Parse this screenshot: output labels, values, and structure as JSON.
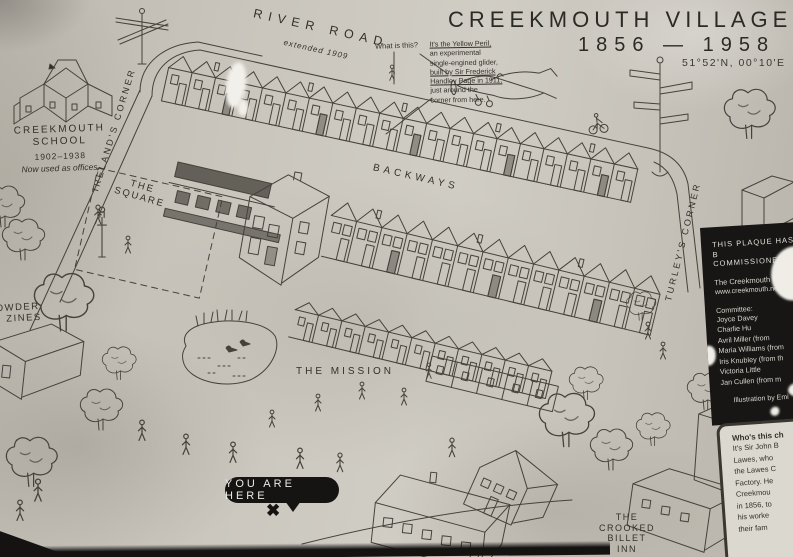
{
  "title": {
    "name": "CREEKMOUTH VILLAGE",
    "years": "1856 — 1958",
    "coordinates": "51°52'N, 00°10'E"
  },
  "map_labels": {
    "river_road": "RIVER ROAD",
    "river_road_note": "extended 1909",
    "irelands_corner": "IRELAND'S CORNER",
    "turleys_corner": "TURLEY'S CORNER",
    "the_square_line1": "THE",
    "the_square_line2": "SQUARE",
    "backways": "BACKWAYS",
    "the_mission": "THE MISSION",
    "powder_magazines_line1": "OWDER",
    "powder_magazines_line2": "ZINES",
    "crooked_billet_line1": "THE",
    "crooked_billet_line2": "CROOKED",
    "crooked_billet_line3": "BILLET",
    "crooked_billet_line4": "INN"
  },
  "school_note": {
    "line1": "CREEKMOUTH",
    "line2": "SCHOOL",
    "years": "1902–1938",
    "note": "Now used as offices."
  },
  "glider_annotation": {
    "question": "What is this?",
    "answer_line1": "It's the Yellow Peril,",
    "answer_line2": "an experimental",
    "answer_line3": "single-engined glider,",
    "answer_line4": "built by Sir Frederick",
    "answer_line5": "Handley Page in 1911,",
    "answer_line6": "just around the",
    "answer_line7": "corner from here."
  },
  "you_are_here": {
    "label": "YOU ARE HERE",
    "marker": "✖"
  },
  "plaque_panel": {
    "heading_line1": "THIS PLAQUE HAS B",
    "heading_line2": "COMMISSIONED BY",
    "organisation": "The Creekmouth Prese",
    "website": "www.creekmouth.net",
    "committee_heading": "Committee:",
    "members": [
      "Joyce Davey",
      "Charlie Hu",
      "Avril Miller (from",
      "Maria Williams (from",
      "Iris Knubley (from th",
      "Victoria Little",
      "Jan Cullen (from m"
    ],
    "credit": "Illustration by Emi"
  },
  "who_panel": {
    "heading": "Who's this ch",
    "body_line1": "It's Sir John B",
    "body_line2": "Lawes, who",
    "body_line3": "the Lawes C",
    "body_line4": "Factory. He",
    "body_line5": "Creekmou",
    "body_line6": "in 1856, to",
    "body_line7": "his worke",
    "body_line8": "their fam"
  },
  "colors": {
    "paper": "#c9c5bc",
    "ink": "#45423b",
    "panel_black": "#171614",
    "panel_text": "#d9d6cf"
  }
}
